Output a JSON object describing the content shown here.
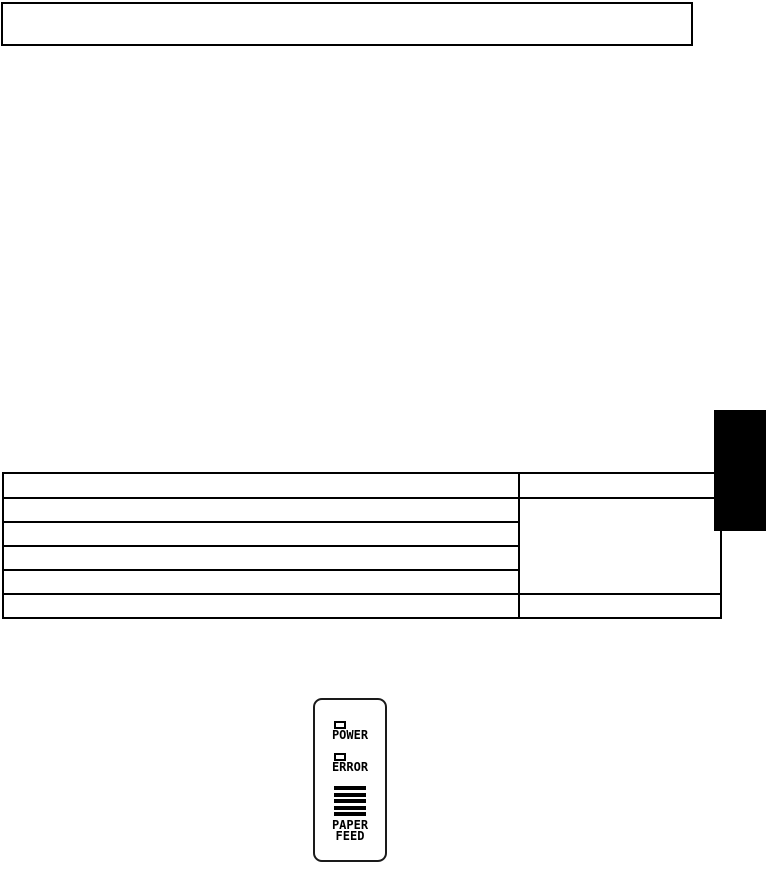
{
  "note_box": {
    "text": ""
  },
  "table": {
    "columns": 2,
    "header_row": {
      "left": "",
      "right": ""
    },
    "body_rows": [
      "",
      "",
      "",
      ""
    ],
    "merged_right_cell": "",
    "footer_row": {
      "left": "",
      "right": ""
    }
  },
  "side_tab": {
    "color": "#000000"
  },
  "control_panel": {
    "power_label": "POWER",
    "error_label": "ERROR",
    "paper_feed_line1": "PAPER",
    "paper_feed_line2": "FEED",
    "led_color": "#ffffff",
    "outline_color": "#1a1a1a",
    "bar_color": "#000000"
  }
}
